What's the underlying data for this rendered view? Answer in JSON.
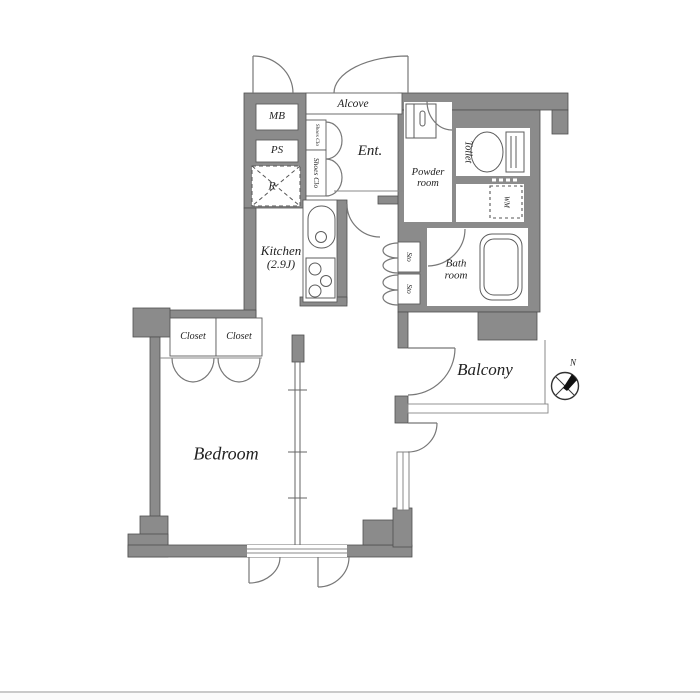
{
  "page": {
    "background": "#ffffff",
    "footer_line_color": "#c9c9c9",
    "footer_strip_color": "#fafafa"
  },
  "floorplan": {
    "wall_color": "#8b8b8b",
    "wall_outline": "#4f4f4f",
    "door_line_color": "#777777",
    "fixture_line_color": "#5c5c5c",
    "text_color": "#222222",
    "labels": {
      "mb": "MB",
      "ps": "PS",
      "refrigerator": "R",
      "alcove": "Alcove",
      "shoes_closet_small": "Shoes Clo",
      "shoes_closet": "Shoes Clo",
      "entrance": "Ent.",
      "powder_line1": "Powder",
      "powder_line2": "room",
      "toilet": "Toilet",
      "washer": "WM",
      "storage_top": "Sto",
      "storage_bottom": "Sto",
      "bath_line1": "Bath",
      "bath_line2": "room",
      "kitchen_line1": "Kitchen",
      "kitchen_line2": "(2.9J)",
      "closet_left": "Closet",
      "closet_right": "Closet",
      "bedroom": "Bedroom",
      "balcony": "Balcony",
      "compass_north": "N"
    }
  }
}
